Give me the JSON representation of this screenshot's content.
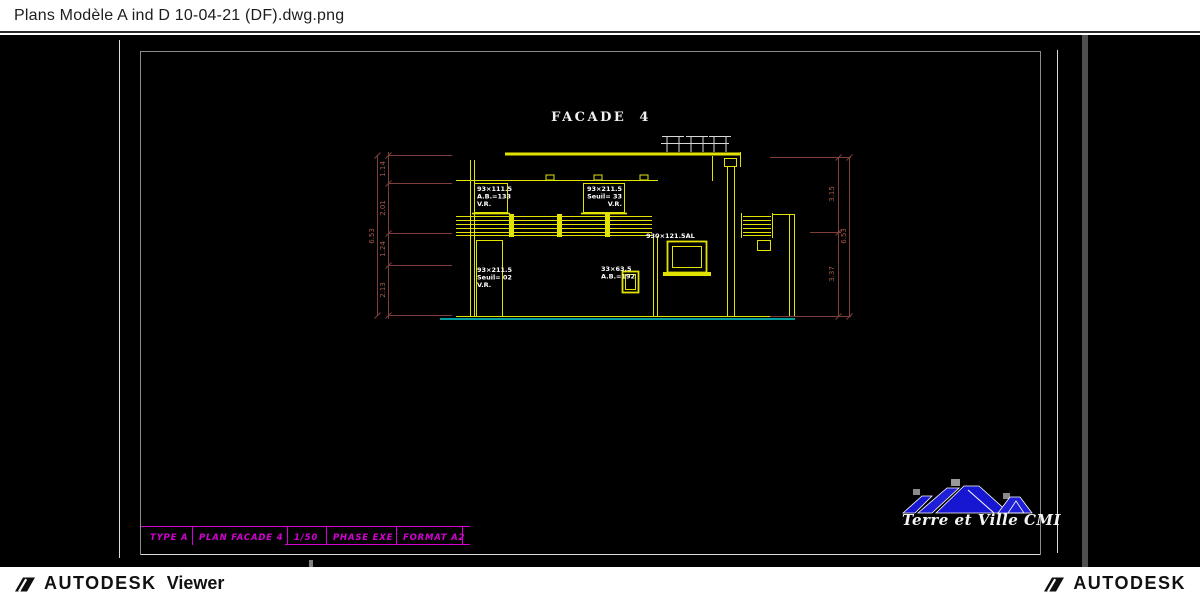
{
  "header": {
    "filename": "Plans Modèle A ind D 10-04-21 (DF).dwg.png"
  },
  "footer": {
    "left": {
      "brand": "AUTODESK",
      "product": "Viewer"
    },
    "right": {
      "brand": "AUTODESK"
    }
  },
  "drawing": {
    "view_title": "FACADE 4",
    "annotations": {
      "window_top_left": {
        "line1": "93×111.5",
        "line2": "A.B.=133",
        "line3": "V.R."
      },
      "window_top_right": {
        "line1": "93×211.5",
        "line2": "Seuil= 33",
        "line3": "V.R."
      },
      "door_bottom_left": {
        "line1": "93×211.5",
        "line2": "Seuil= 02",
        "line3": "V.R."
      },
      "window_bottom_small": {
        "line1": "33×63.5",
        "line2": "A.B.=192"
      },
      "bay_window": "930×121.5AL"
    },
    "dimensions": {
      "left_segments": [
        "1.14",
        "2.01",
        "1.24",
        "2.13"
      ],
      "left_total": "6.53",
      "right_segments": [
        "3.15",
        "3.37"
      ],
      "right_total": "6.53"
    },
    "title_block": [
      "TYPE A",
      "PLAN FACADE 4",
      "1/50",
      "PHASE EXE",
      "FORMAT A2"
    ],
    "logo": {
      "company": "Terre et Ville CMI"
    },
    "colors": {
      "cad_yellow": "#e3e300",
      "cad_white": "#d8d8d8",
      "ground_teal": "#00a0a0",
      "dimension_red": "#7e3f3a",
      "title_magenta": "#d400d4",
      "logo_blue": "#1717d1"
    }
  }
}
